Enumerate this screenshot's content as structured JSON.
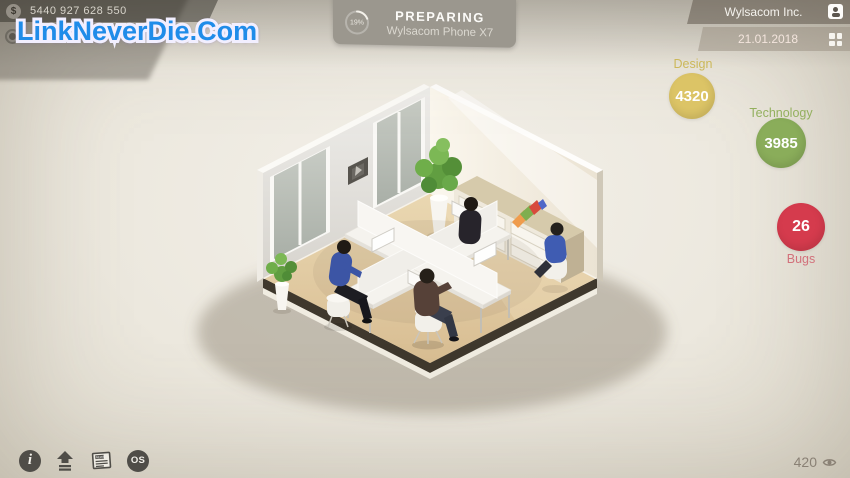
{
  "hud": {
    "money": {
      "currency_glyph": "$",
      "value": "5440 927 628 550"
    },
    "watermark": "LinkNeverDie.Com",
    "production": {
      "progress_percent": 19,
      "progress_label": "19%",
      "status": "PREPARING",
      "product": "Wylsacom Phone X7",
      "panel_color": "#9b978e"
    },
    "company": {
      "name": "Wylsacom Inc.",
      "date": "21.01.2018"
    },
    "stats": {
      "design": {
        "label": "Design",
        "value": "4320",
        "color": "#dcc466",
        "label_color": "#ccb85a"
      },
      "technology": {
        "label": "Technology",
        "value": "3985",
        "color": "#8aad5a",
        "label_color": "#93b05e"
      },
      "bugs": {
        "label": "Bugs",
        "value": "26",
        "color": "#d53b4d",
        "label_color": "#d2717b"
      }
    },
    "toolbar": {
      "info_glyph": "i",
      "news_label": "NEWS",
      "os_label": "OS"
    },
    "followers": {
      "value": "420"
    }
  },
  "scene": {
    "name": "isometric-office",
    "employees": 4,
    "floor_color": "#dcc096",
    "accent_folder_colors": [
      "#ef9c4d",
      "#7fae4f",
      "#d84a3c",
      "#4f67c8"
    ]
  }
}
